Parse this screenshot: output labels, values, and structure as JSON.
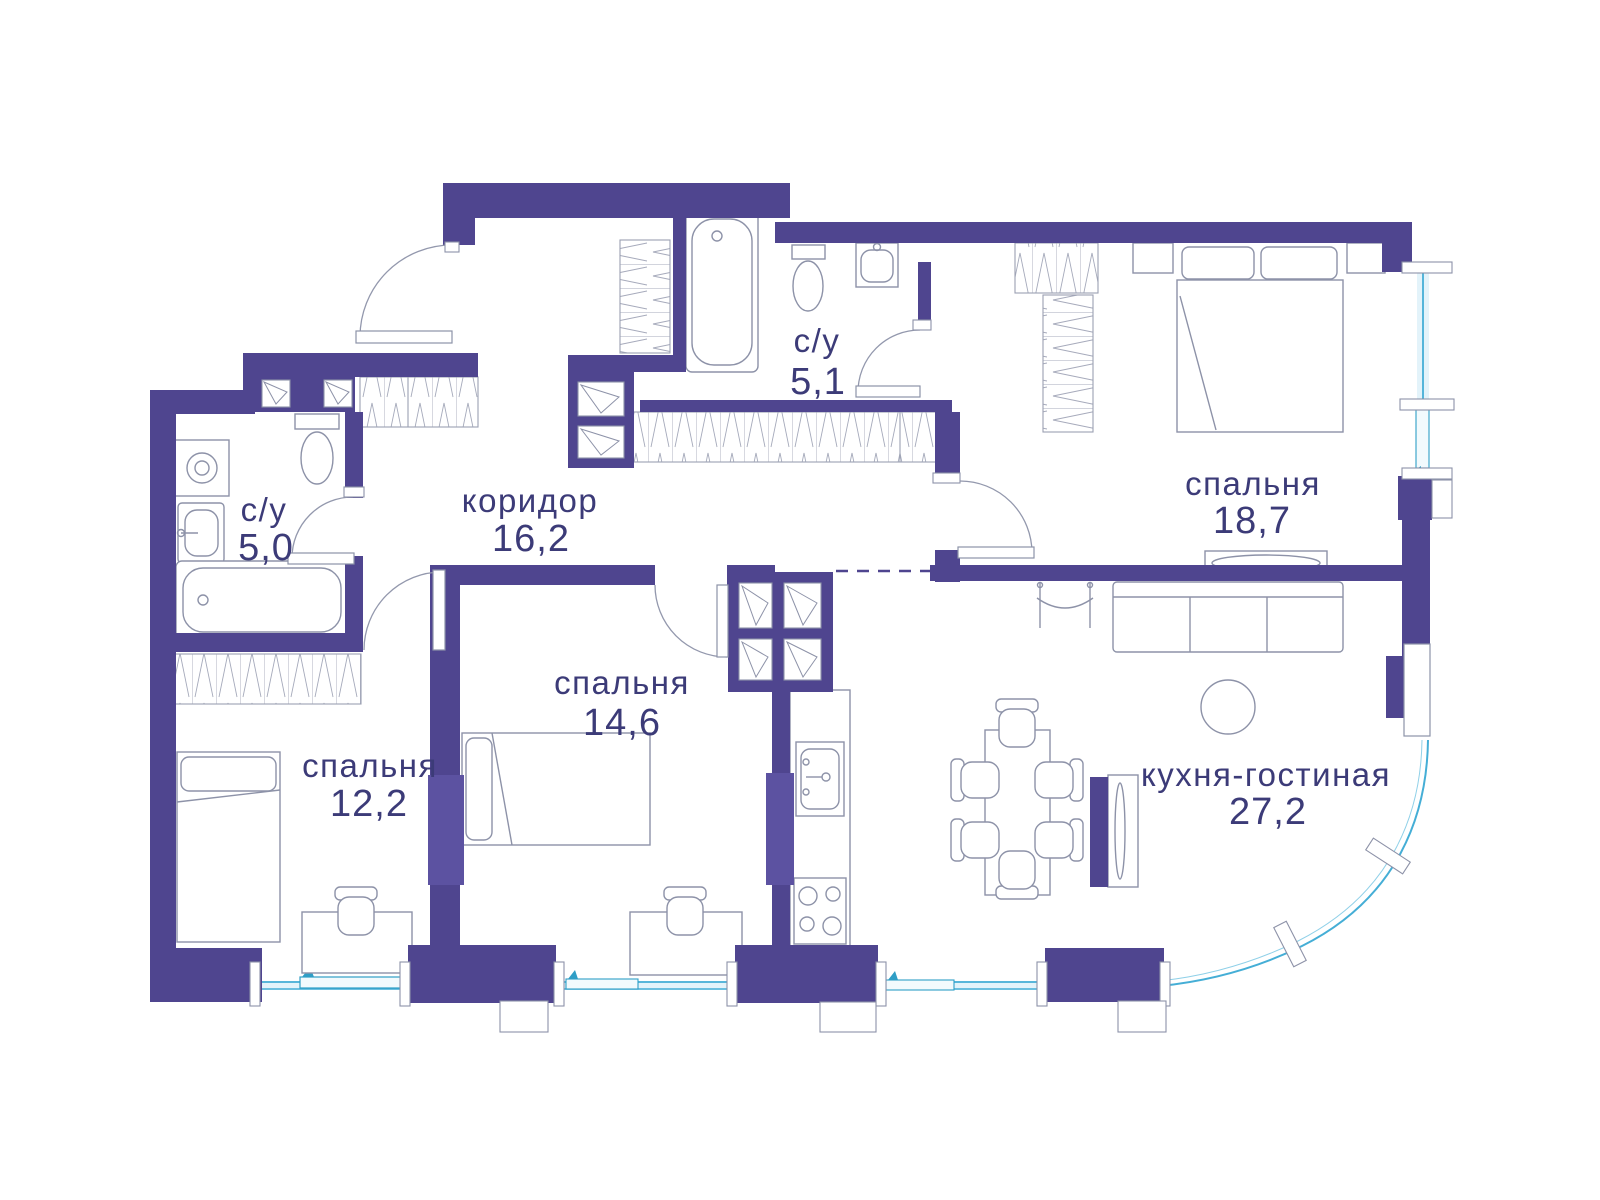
{
  "floor_plan": {
    "rooms": [
      {
        "key": "bathroom_top",
        "label": "с/у",
        "area": "5,1"
      },
      {
        "key": "bedroom_large",
        "label": "спальня",
        "area": "18,7"
      },
      {
        "key": "bathroom_left",
        "label": "с/у",
        "area": "5,0"
      },
      {
        "key": "corridor",
        "label": "коридор",
        "area": "16,2"
      },
      {
        "key": "bedroom_middle",
        "label": "спальня",
        "area": "14,6"
      },
      {
        "key": "bedroom_small",
        "label": "спальня",
        "area": "12,2"
      },
      {
        "key": "kitchen_living",
        "label": "кухня-гостиная",
        "area": "27,2"
      }
    ],
    "colors": {
      "wall": "#4f458f",
      "wall_light": "#5c52a1",
      "text": "#3c3b78",
      "window": "#45aed6",
      "window_pale": "#c6e6f3",
      "furniture_line": "#8d92a8"
    }
  }
}
